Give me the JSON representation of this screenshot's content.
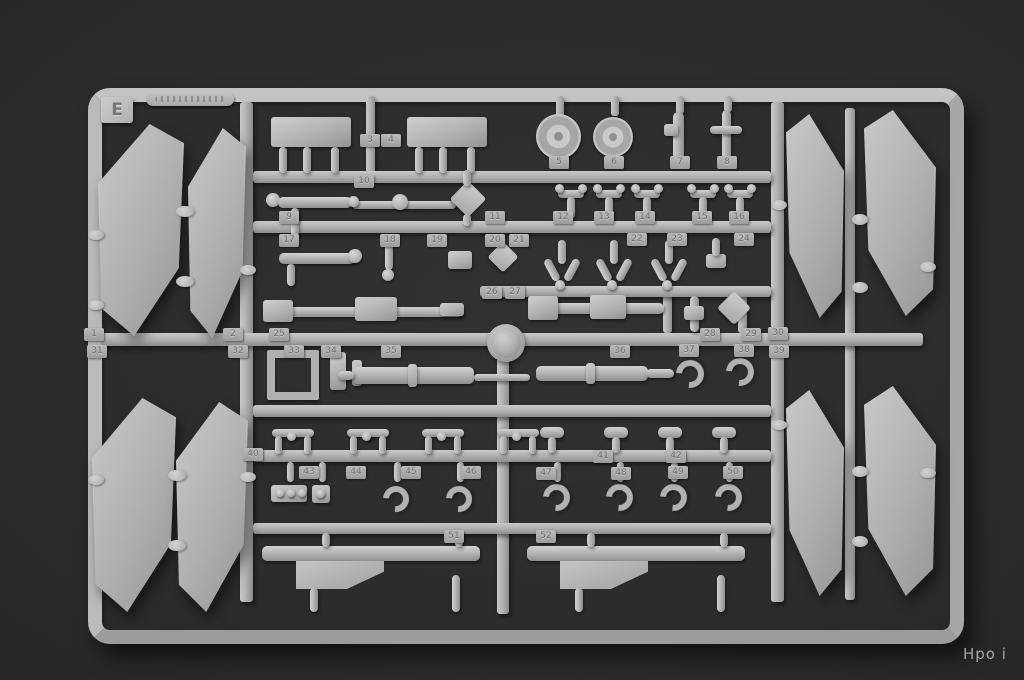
{
  "scene": {
    "description": "Photograph of gray plastic model-kit sprue E on dark backdrop",
    "sprue_letter": "E",
    "watermark_text": "Hpo i",
    "part_tags": [
      {
        "n": "1",
        "x": 93,
        "y": 335
      },
      {
        "n": "2",
        "x": 232,
        "y": 335
      },
      {
        "n": "3",
        "x": 369,
        "y": 141
      },
      {
        "n": "4",
        "x": 390,
        "y": 141
      },
      {
        "n": "5",
        "x": 558,
        "y": 163
      },
      {
        "n": "6",
        "x": 613,
        "y": 163
      },
      {
        "n": "7",
        "x": 679,
        "y": 163
      },
      {
        "n": "8",
        "x": 726,
        "y": 163
      },
      {
        "n": "9",
        "x": 288,
        "y": 218
      },
      {
        "n": "10",
        "x": 363,
        "y": 182
      },
      {
        "n": "11",
        "x": 494,
        "y": 218
      },
      {
        "n": "12",
        "x": 562,
        "y": 218
      },
      {
        "n": "13",
        "x": 603,
        "y": 218
      },
      {
        "n": "14",
        "x": 644,
        "y": 218
      },
      {
        "n": "15",
        "x": 701,
        "y": 218
      },
      {
        "n": "16",
        "x": 738,
        "y": 218
      },
      {
        "n": "17",
        "x": 288,
        "y": 241
      },
      {
        "n": "18",
        "x": 389,
        "y": 241
      },
      {
        "n": "19",
        "x": 436,
        "y": 241
      },
      {
        "n": "20",
        "x": 494,
        "y": 241
      },
      {
        "n": "21",
        "x": 518,
        "y": 241
      },
      {
        "n": "22",
        "x": 636,
        "y": 240
      },
      {
        "n": "23",
        "x": 676,
        "y": 240
      },
      {
        "n": "24",
        "x": 743,
        "y": 240
      },
      {
        "n": "25",
        "x": 278,
        "y": 335
      },
      {
        "n": "26",
        "x": 491,
        "y": 293
      },
      {
        "n": "27",
        "x": 514,
        "y": 293
      },
      {
        "n": "28",
        "x": 709,
        "y": 335
      },
      {
        "n": "29",
        "x": 750,
        "y": 335
      },
      {
        "n": "30",
        "x": 777,
        "y": 334
      },
      {
        "n": "31",
        "x": 96,
        "y": 352
      },
      {
        "n": "32",
        "x": 237,
        "y": 352
      },
      {
        "n": "33",
        "x": 293,
        "y": 352
      },
      {
        "n": "34",
        "x": 330,
        "y": 352
      },
      {
        "n": "35",
        "x": 390,
        "y": 352
      },
      {
        "n": "36",
        "x": 619,
        "y": 352
      },
      {
        "n": "37",
        "x": 688,
        "y": 351
      },
      {
        "n": "38",
        "x": 743,
        "y": 351
      },
      {
        "n": "39",
        "x": 778,
        "y": 352
      },
      {
        "n": "40",
        "x": 252,
        "y": 455
      },
      {
        "n": "41",
        "x": 602,
        "y": 457
      },
      {
        "n": "42",
        "x": 675,
        "y": 457
      },
      {
        "n": "43",
        "x": 308,
        "y": 473
      },
      {
        "n": "44",
        "x": 355,
        "y": 473
      },
      {
        "n": "45",
        "x": 410,
        "y": 473
      },
      {
        "n": "46",
        "x": 470,
        "y": 473
      },
      {
        "n": "47",
        "x": 545,
        "y": 474
      },
      {
        "n": "48",
        "x": 620,
        "y": 474
      },
      {
        "n": "49",
        "x": 677,
        "y": 473
      },
      {
        "n": "50",
        "x": 732,
        "y": 473
      },
      {
        "n": "51",
        "x": 453,
        "y": 537
      },
      {
        "n": "52",
        "x": 545,
        "y": 537
      }
    ],
    "colors": {
      "background": "#2b2a29",
      "plastic": "#b2b2b2",
      "plastic_highlight": "#d2d2d2",
      "plastic_shadow": "#8a8a8a",
      "watermark": "#a6a6a2"
    }
  }
}
